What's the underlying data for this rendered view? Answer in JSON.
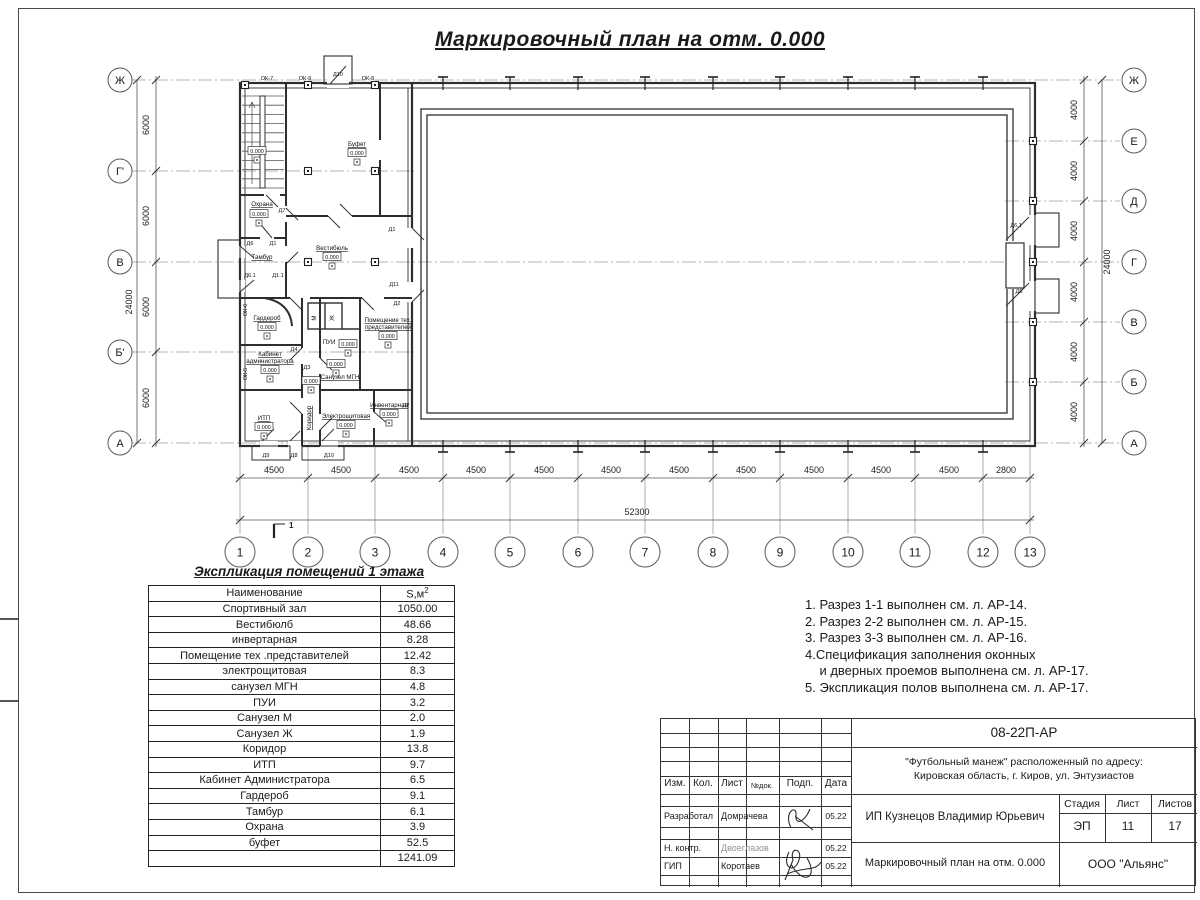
{
  "sheet": {
    "title": "Маркировочный план на отм. 0.000"
  },
  "plan": {
    "level_value": "0.000",
    "section_mark": "1",
    "axes_left": [
      {
        "label": "Ж",
        "y": 80
      },
      {
        "label": "Г'",
        "y": 171
      },
      {
        "label": "В",
        "y": 262
      },
      {
        "label": "Б'",
        "y": 352
      },
      {
        "label": "А",
        "y": 443
      }
    ],
    "axes_right": [
      {
        "label": "Ж",
        "y": 80
      },
      {
        "label": "Е",
        "y": 141
      },
      {
        "label": "Д",
        "y": 201
      },
      {
        "label": "Г",
        "y": 262
      },
      {
        "label": "В",
        "y": 322
      },
      {
        "label": "Б",
        "y": 382
      },
      {
        "label": "А",
        "y": 443
      }
    ],
    "axes_bottom": [
      {
        "label": "1",
        "x": 240
      },
      {
        "label": "2",
        "x": 308
      },
      {
        "label": "3",
        "x": 375
      },
      {
        "label": "4",
        "x": 443
      },
      {
        "label": "5",
        "x": 510
      },
      {
        "label": "6",
        "x": 578
      },
      {
        "label": "7",
        "x": 645
      },
      {
        "label": "8",
        "x": 713
      },
      {
        "label": "9",
        "x": 780
      },
      {
        "label": "10",
        "x": 848
      },
      {
        "label": "11",
        "x": 915
      },
      {
        "label": "12",
        "x": 983
      },
      {
        "label": "13",
        "x": 1030
      }
    ],
    "dims_bottom": [
      {
        "text": "4500",
        "x": 274
      },
      {
        "text": "4500",
        "x": 341
      },
      {
        "text": "4500",
        "x": 409
      },
      {
        "text": "4500",
        "x": 476
      },
      {
        "text": "4500",
        "x": 544
      },
      {
        "text": "4500",
        "x": 611
      },
      {
        "text": "4500",
        "x": 679
      },
      {
        "text": "4500",
        "x": 746
      },
      {
        "text": "4500",
        "x": 814
      },
      {
        "text": "4500",
        "x": 881
      },
      {
        "text": "4500",
        "x": 949
      },
      {
        "text": "2800",
        "x": 1006
      }
    ],
    "dim_total_bottom": "52300",
    "dims_left": [
      {
        "text": "6000",
        "y": 125
      },
      {
        "text": "6000",
        "y": 216
      },
      {
        "text": "6000",
        "y": 307
      },
      {
        "text": "6000",
        "y": 398
      }
    ],
    "dim_total_left": "24000",
    "dims_right": [
      {
        "text": "4000",
        "y": 110
      },
      {
        "text": "4000",
        "y": 171
      },
      {
        "text": "4000",
        "y": 231
      },
      {
        "text": "4000",
        "y": 292
      },
      {
        "text": "4000",
        "y": 352
      },
      {
        "text": "4000",
        "y": 412
      }
    ],
    "dim_total_right": "24000",
    "rooms": [
      {
        "text": "Буфет",
        "x": 357,
        "y": 146,
        "u": 1
      },
      {
        "text": "Вестибюль",
        "x": 332,
        "y": 250,
        "u": 1
      },
      {
        "text": "Охрана",
        "x": 262,
        "y": 206,
        "u": 1
      },
      {
        "text": "Тамбур",
        "x": 262,
        "y": 259,
        "u": 1
      },
      {
        "text": "Гардероб",
        "x": 267,
        "y": 320,
        "u": 1
      },
      {
        "text": "Кабинет",
        "x": 270,
        "y": 356,
        "u": 1
      },
      {
        "text": "администратора",
        "x": 270,
        "y": 363,
        "u": 1
      },
      {
        "text": "ИТП",
        "x": 264,
        "y": 420,
        "u": 1
      },
      {
        "text": "Коридор",
        "x": 311,
        "y": 418,
        "u": 1,
        "rot": 1
      },
      {
        "text": "Санузел МГН",
        "x": 340,
        "y": 379,
        "u": 1
      },
      {
        "text": "ПУИ",
        "x": 329,
        "y": 344
      },
      {
        "text": "М",
        "x": 316,
        "y": 318,
        "rot": 1
      },
      {
        "text": "Ж",
        "x": 334,
        "y": 318,
        "rot": 1
      },
      {
        "text": "Помещение тех.",
        "x": 388,
        "y": 322,
        "u": 1
      },
      {
        "text": "представителей",
        "x": 388,
        "y": 329,
        "u": 1
      },
      {
        "text": "Электрощитовая",
        "x": 346,
        "y": 418,
        "u": 1
      },
      {
        "text": "Инвентарная",
        "x": 389,
        "y": 407,
        "u": 1
      }
    ],
    "levels": [
      {
        "x": 357,
        "y": 153
      },
      {
        "x": 332,
        "y": 257
      },
      {
        "x": 267,
        "y": 327
      },
      {
        "x": 270,
        "y": 370
      },
      {
        "x": 264,
        "y": 427
      },
      {
        "x": 311,
        "y": 381
      },
      {
        "x": 336,
        "y": 364
      },
      {
        "x": 348,
        "y": 344
      },
      {
        "x": 346,
        "y": 425
      },
      {
        "x": 389,
        "y": 414
      },
      {
        "x": 388,
        "y": 336
      },
      {
        "x": 259,
        "y": 214
      },
      {
        "x": 257,
        "y": 151
      }
    ],
    "doors": [
      {
        "text": "Д10",
        "x": 338,
        "y": 76
      },
      {
        "text": "Д6.1",
        "x": 1016,
        "y": 227
      },
      {
        "text": "Д6",
        "x": 1019,
        "y": 293
      },
      {
        "text": "Д7",
        "x": 282,
        "y": 212
      },
      {
        "text": "Д1",
        "x": 392,
        "y": 231
      },
      {
        "text": "Д11",
        "x": 394,
        "y": 286
      },
      {
        "text": "Д6",
        "x": 250,
        "y": 245
      },
      {
        "text": "Д1",
        "x": 273,
        "y": 245
      },
      {
        "text": "Д6.1",
        "x": 250,
        "y": 277
      },
      {
        "text": "Д1.1",
        "x": 278,
        "y": 277
      },
      {
        "text": "Д4",
        "x": 294,
        "y": 351
      },
      {
        "text": "Д3",
        "x": 307,
        "y": 369
      },
      {
        "text": "Д2",
        "x": 397,
        "y": 305
      },
      {
        "text": "Д2",
        "x": 406,
        "y": 407
      },
      {
        "text": "Д9",
        "x": 266,
        "y": 457
      },
      {
        "text": "Д8",
        "x": 294,
        "y": 457
      },
      {
        "text": "Д10",
        "x": 329,
        "y": 457
      }
    ],
    "windows": [
      {
        "text": "ОК-7",
        "x": 267,
        "y": 80
      },
      {
        "text": "ОК-9",
        "x": 305,
        "y": 80
      },
      {
        "text": "ОК-8",
        "x": 368,
        "y": 80
      },
      {
        "text": "ОК-6",
        "x": 247,
        "y": 310,
        "rot": 1
      },
      {
        "text": "ОК-5",
        "x": 247,
        "y": 374,
        "rot": 1
      }
    ]
  },
  "legend": {
    "title": "Экспликация помещений 1 этажа",
    "columns": [
      "Наименование",
      "S,м²"
    ],
    "rows": [
      [
        "Спортивный зал",
        "1050.00"
      ],
      [
        "Вестибюлб",
        "48.66"
      ],
      [
        "инвертарная",
        "8.28"
      ],
      [
        "Помещение тех .представителей",
        "12.42"
      ],
      [
        "электрощитовая",
        "8.3"
      ],
      [
        "санузел МГН",
        "4.8"
      ],
      [
        "ПУИ",
        "3.2"
      ],
      [
        "Санузел М",
        "2.0"
      ],
      [
        "Санузел Ж",
        "1.9"
      ],
      [
        "Коридор",
        "13.8"
      ],
      [
        "ИТП",
        "9.7"
      ],
      [
        "Кабинет Администратора",
        "6.5"
      ],
      [
        "Гардероб",
        "9.1"
      ],
      [
        "Тамбур",
        "6.1"
      ],
      [
        "Охрана",
        "3.9"
      ],
      [
        "буфет",
        "52.5"
      ],
      [
        "",
        "1241.09"
      ]
    ]
  },
  "notes": [
    "1. Разрез 1-1 выполнен см. л. АР-14.",
    "2. Разрез 2-2 выполнен см. л. АР-15.",
    "3. Разрез 3-3 выполнен см. л. АР-16.",
    "4.Спецификация заполнения оконных",
    "    и дверных проемов выполнена см. л. АР-17.",
    "5. Экспликация полов выполнена см. л. АР-17."
  ],
  "title_block": {
    "doc_number": "08-22П-АР",
    "project_line1": "\"Футбольный манеж\" расположенный по адресу:",
    "project_line2": "Кировская область, г. Киров, ул. Энтузиастов",
    "client": "ИП Кузнецов Владимир Юрьевич",
    "sheet_title": "Маркировочный план на отм. 0.000",
    "company": "ООО \"Альянс\"",
    "header_cells": [
      "Изм.",
      "Кол.",
      "Лист",
      "№док.",
      "Подп.",
      "Дата"
    ],
    "stage_label": "Стадия",
    "sheet_label": "Лист",
    "sheets_label": "Листов",
    "stage": "ЭП",
    "sheet_no": "11",
    "sheets_total": "17",
    "signers": [
      {
        "role": "Разработал",
        "name": "Домрачева",
        "date": "05.22"
      },
      {
        "role": "Н. контр.",
        "name": "Двоеглазов",
        "date": "05.22"
      },
      {
        "role": "ГИП",
        "name": "Коротаев",
        "date": "05.22"
      }
    ]
  }
}
